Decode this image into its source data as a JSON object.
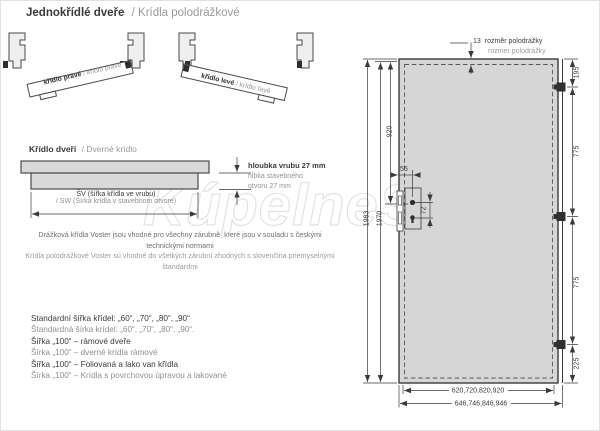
{
  "header": {
    "title_cz": "Jednokřídlé dveře",
    "title_sk": "/ Krídla polodrážkové"
  },
  "watermark": {
    "text": "KúpelneSK"
  },
  "hinge_diagrams": {
    "right_leaf_cz": "křídlo pravé",
    "right_leaf_sk": "/ krídlo pravé",
    "left_leaf_cz": "křídlo levé",
    "left_leaf_sk": "/ krídlo ľavé"
  },
  "leaf_section": {
    "heading_cz": "Křídlo dveří",
    "heading_sk": "/ Dverné krídlo",
    "depth_cz": "hloubka vrubu 27 mm",
    "depth_sk_line1": "hĺbka stavebného",
    "depth_sk_line2": "otvoru 27 mm",
    "width_cz": "ŠV (šířka křídla ve vrubu)",
    "width_sk": "/ SW (Šírka krídla v stavebnom otvore)"
  },
  "compatibility_note": {
    "cz": "Drážková křídla Voster jsou vhodné pro všechny zárubně, které jsou v souladu s českými technickými normami",
    "sk": "Krídla polodrážkové Voster sú vhodné do všetkých zárubní zhodných s slovenčina priemyselnými štandardmi"
  },
  "width_options": {
    "lines": [
      {
        "text": "Standardní šířka křídel: „60“, „70“, „80“, „90“"
      },
      {
        "text": "Štandardná šírka krídel: „60“, „70“, „80“, „90“."
      },
      {
        "text": "Šířka „100“ – rámové dveře"
      },
      {
        "text": "Šírka „100“ – dverné krídla rámové"
      },
      {
        "text": "Šířka „100“ – Foliovaná a lako van křídla"
      },
      {
        "text": "Šírka „100“ – Krídla s povrchovou úpravou a lakované"
      }
    ]
  },
  "door_drawing": {
    "rebate": {
      "value": "13",
      "label_cz": "rozměr polodrážky",
      "label_sk": "rozmer polodrážky"
    },
    "dims": {
      "total_height": "1983",
      "leaf_height": "1970",
      "handle_from_top": "920",
      "top_to_hinge": "195",
      "hinge_gap_upper": "775",
      "hinge_gap_lower": "775",
      "hinge_to_bottom": "225",
      "lock_backset": "55",
      "handle_key_distance": "72",
      "leaf_widths": "620,720,820,920",
      "outer_widths": "646,746,846,946"
    }
  },
  "colors": {
    "door_fill": "#d6d6d6",
    "line": "#3a3a3a",
    "secondary_text": "#9a9a9a",
    "watermark": "#e3e3e3"
  }
}
